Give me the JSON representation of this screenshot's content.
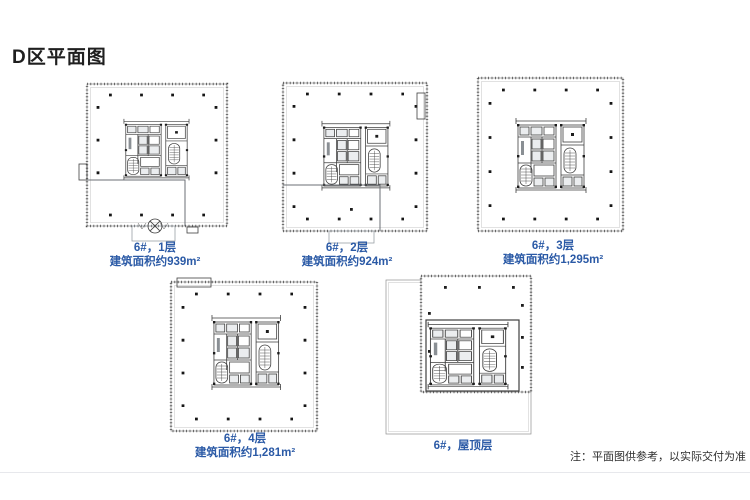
{
  "page": {
    "title": "D区平面图",
    "note": "注：平面图供参考，以实际交付为准"
  },
  "plans": [
    {
      "name": "6#，1层",
      "area": "建筑面积约939m²"
    },
    {
      "name": "6#，2层",
      "area": "建筑面积约924m²"
    },
    {
      "name": "6#，3层",
      "area": "建筑面积约1,295m²"
    },
    {
      "name": "6#，4层",
      "area": "建筑面积约1,281m²"
    },
    {
      "name": "6#，屋顶层"
    }
  ],
  "colors": {
    "label_blue": "#2b5aa6",
    "plan_line": "#4c4c4c",
    "divider": "#e7e8ec"
  }
}
